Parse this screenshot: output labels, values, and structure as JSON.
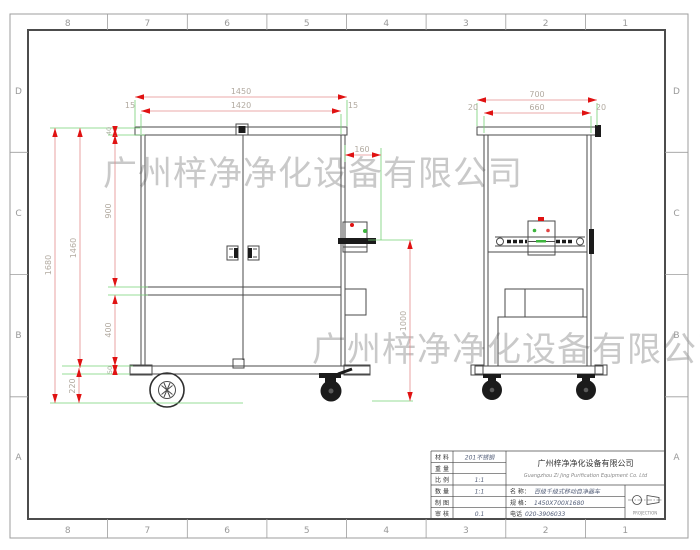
{
  "frame": {
    "cols": [
      "8",
      "7",
      "6",
      "5",
      "4",
      "3",
      "2",
      "1"
    ],
    "rows": [
      "D",
      "C",
      "B",
      "A"
    ]
  },
  "watermark": {
    "text": "广州梓净净化设备有限公司"
  },
  "front_view": {
    "dims": {
      "overall_width": "1450",
      "inner_width": "1420",
      "margin_left": "15",
      "margin_right": "15",
      "box_offset": "160",
      "box_height": "1000",
      "overall_height": "1680",
      "body_height": "1460",
      "top_offset": "40",
      "door_height": "900",
      "lower_height": "400",
      "chassis_height": "50",
      "wheel_height": "220"
    }
  },
  "side_view": {
    "dims": {
      "overall_depth": "700",
      "inner_depth": "660",
      "margin_left": "20",
      "margin_right": "20"
    }
  },
  "title_block": {
    "left_rows": [
      {
        "label": "材 料",
        "value": "201不锈钢"
      },
      {
        "label": "重 量",
        "value": ""
      },
      {
        "label": "比 例",
        "value": "1:1"
      },
      {
        "label": "数 量",
        "value": "1:1"
      },
      {
        "label": "制 图",
        "value": ""
      },
      {
        "label": "审 核",
        "value": "0.1"
      }
    ],
    "company_cn": "广州梓净净化设备有限公司",
    "company_en": "Guangzhou Zi Jing Purification Equipment Co. Ltd",
    "name_label": "名  称：",
    "name_value": "百级千级式移动自净器车",
    "spec_label": "规  格：",
    "spec_value": "1450X700X1680",
    "phone_label": "电话",
    "phone_value": "020-3906033",
    "projection_label": "PROJECTION"
  },
  "colors": {
    "dim_line": "#e58c8c",
    "dim_arrow": "#e01212",
    "extension_line": "#74d074",
    "dim_text": "#b2aaa0",
    "drawing_line": "#4a4a4a",
    "watermark": "#c9c9c9",
    "indicator_red": "#e01212",
    "indicator_green": "#3db53d"
  }
}
